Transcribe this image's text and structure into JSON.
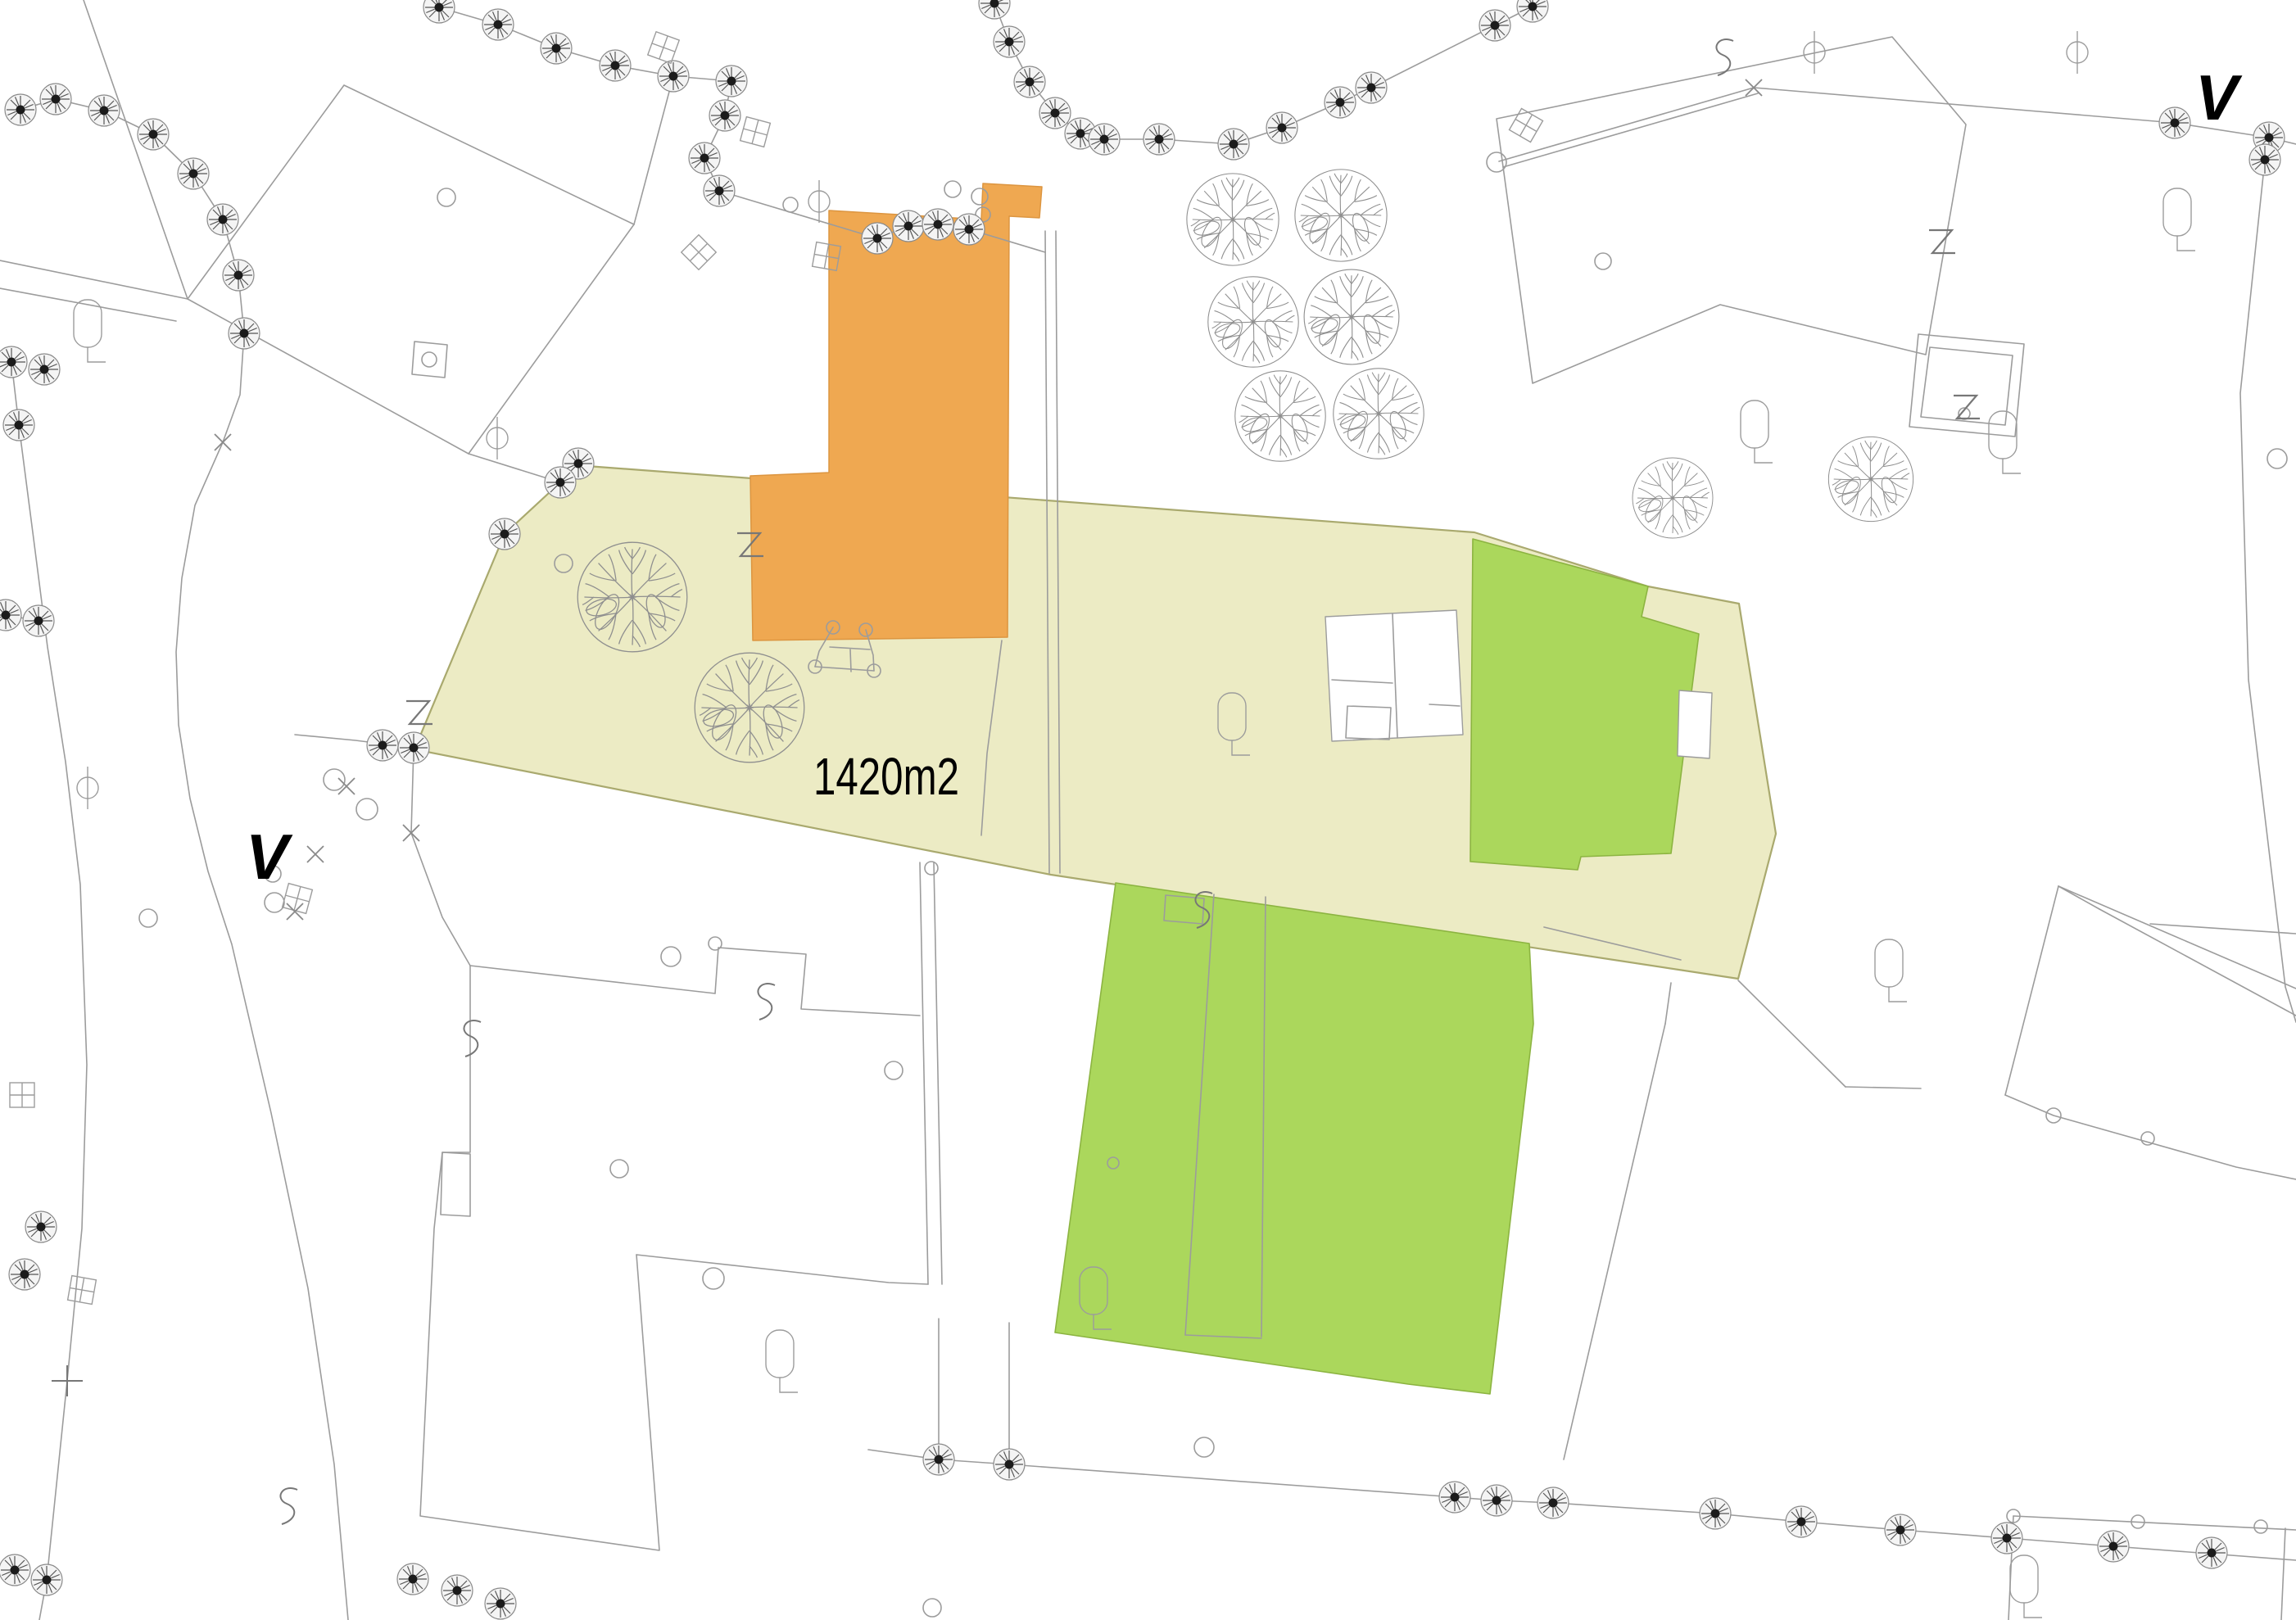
{
  "page": {
    "title": "Cadastral site plan with highlighted parcel and buildings"
  },
  "labels": {
    "area": "1420m2",
    "v_left": "V",
    "v_right": "V"
  },
  "colors": {
    "pale": "#ECEBC4",
    "paleStroke": "#A9A96E",
    "orange": "#EFA851",
    "orangeStroke": "#DC9540",
    "green": "#ABD75C",
    "greenStroke": "#8CB441",
    "line": "#9C9C9C",
    "lineDark": "#707070",
    "pointCore": "#1B1B1B",
    "text": "#000000"
  }
}
